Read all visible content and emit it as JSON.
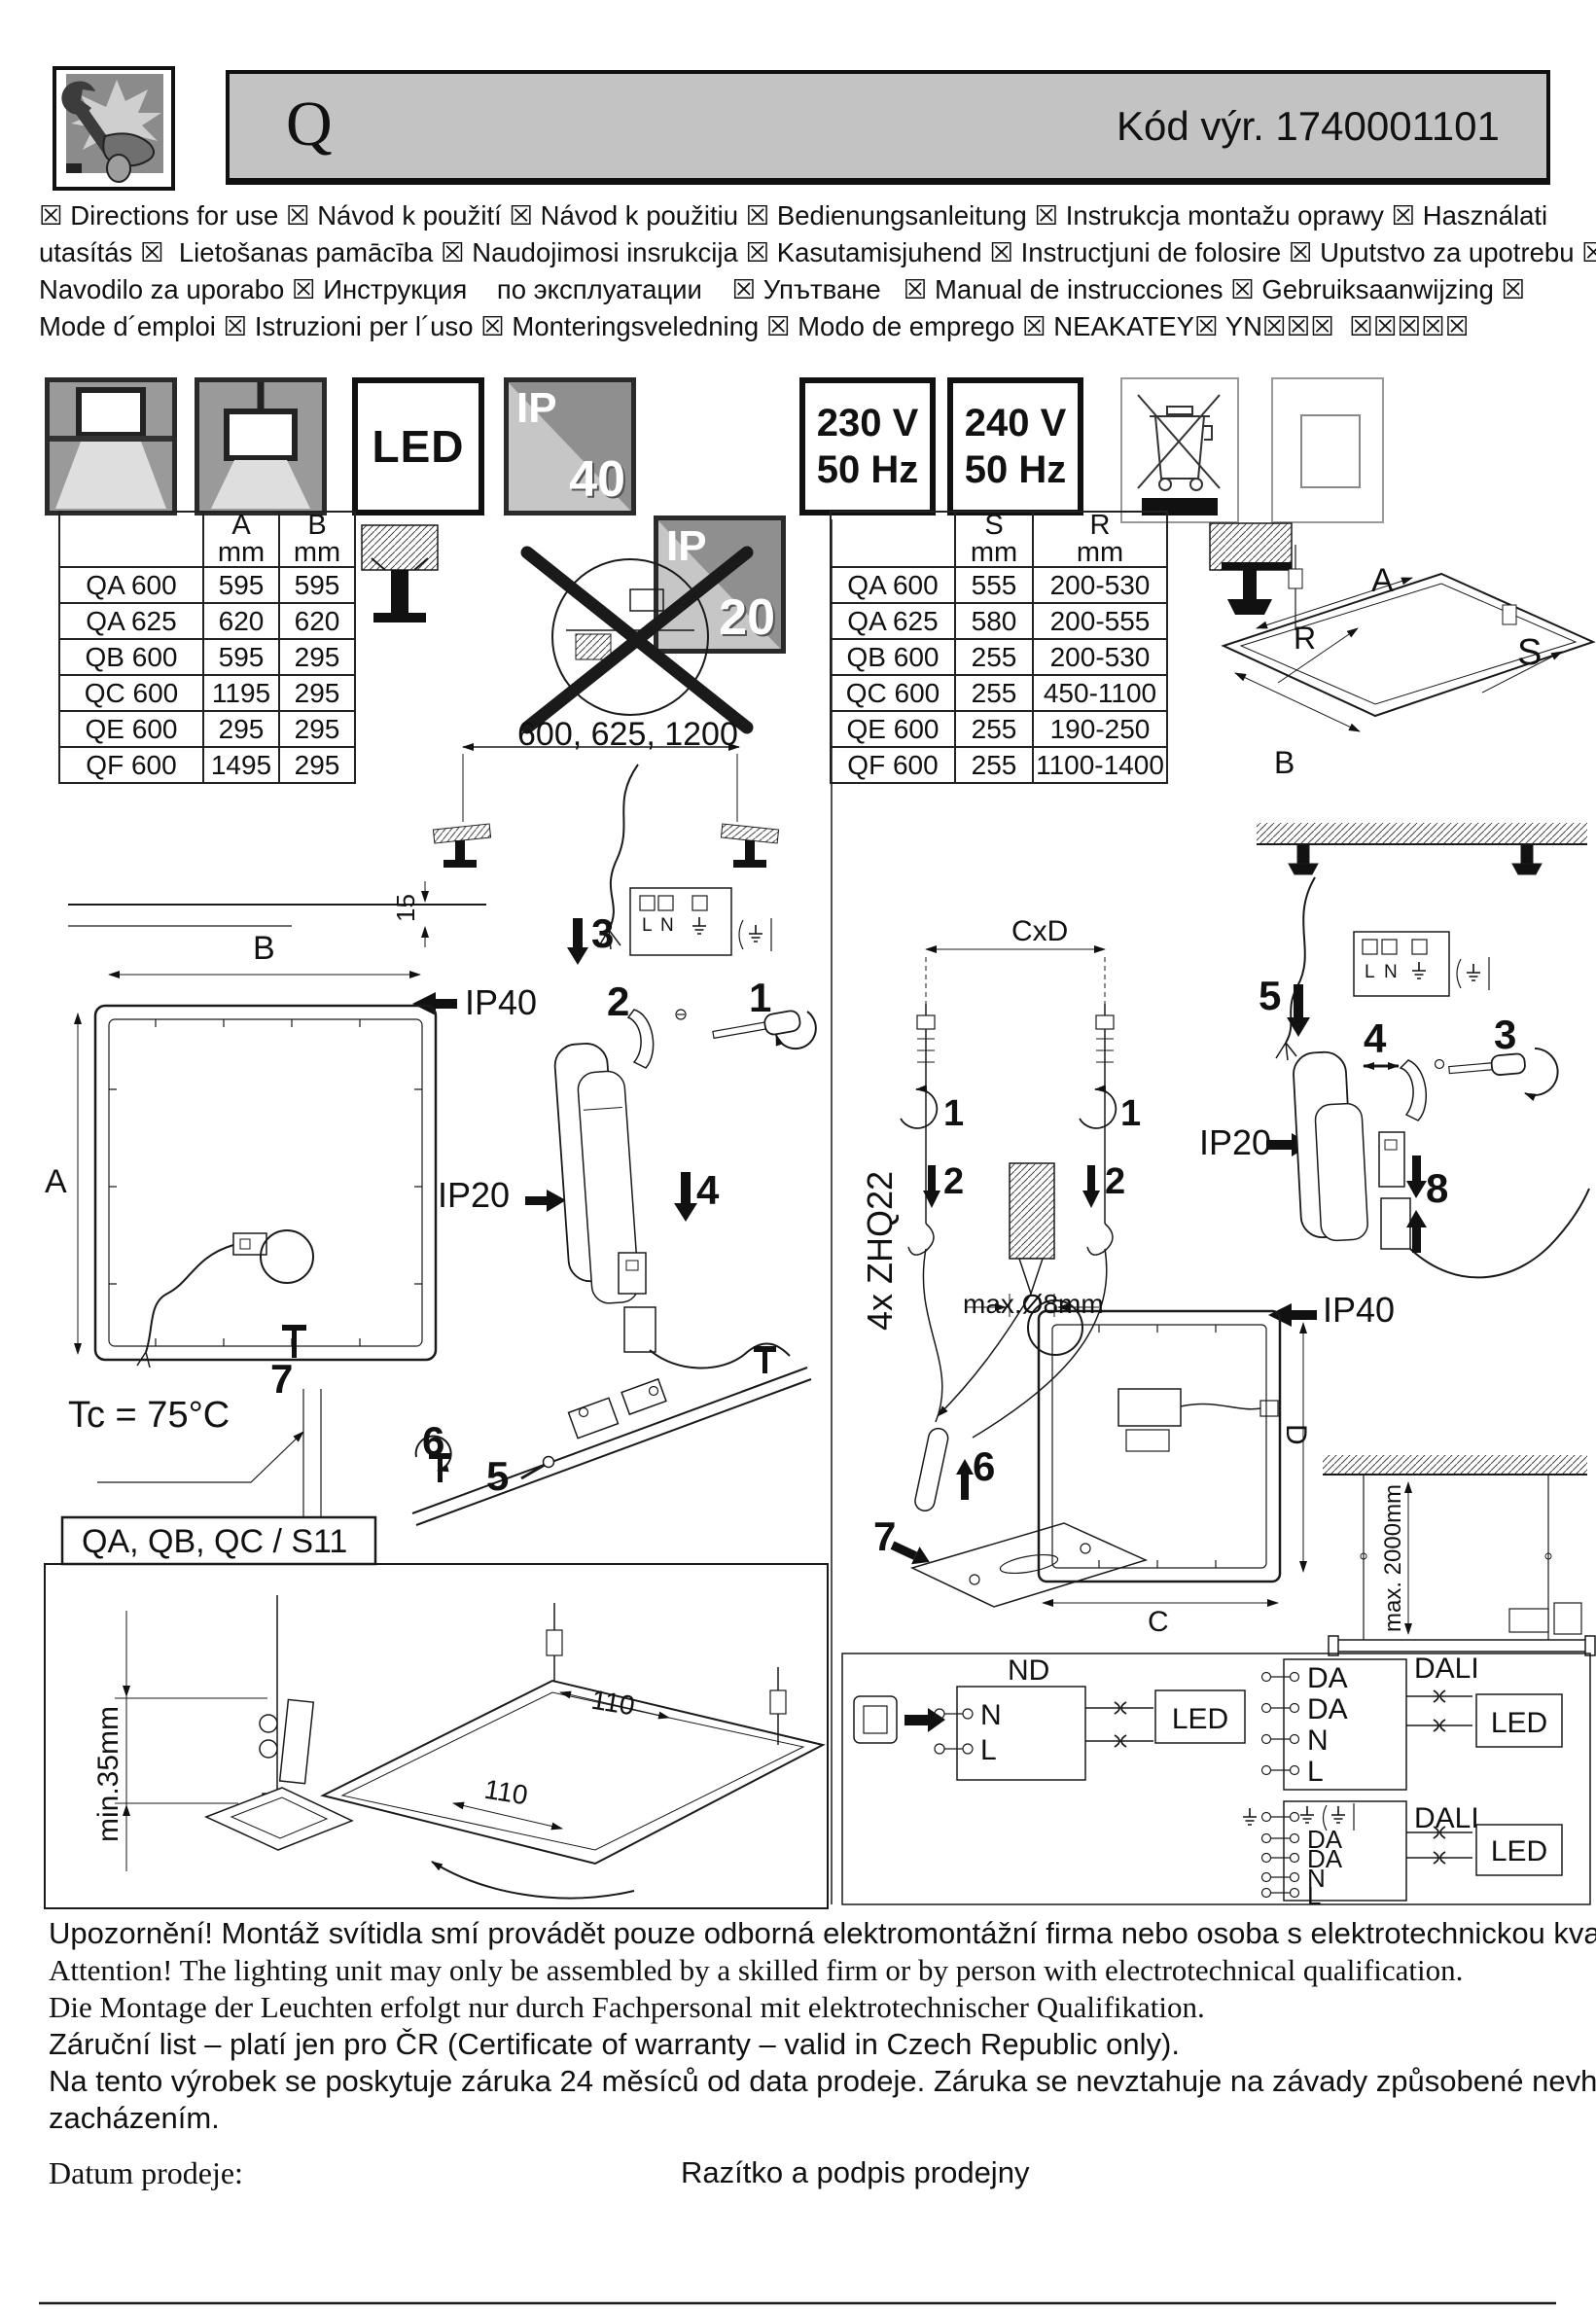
{
  "header": {
    "product_letter": "Q",
    "code": "Kód výr.  1740001101"
  },
  "languages": {
    "lines": [
      "☒ Directions for use ☒ Návod k použití ☒ Návod k použitiu ☒ Bedienungsanleitung ☒ Instrukcja montažu oprawy ☒ Használati",
      "utasítás ☒  Lietošanas pamācība ☒ Naudojimosi insrukcija ☒ Kasutamisjuhend ☒ Instructjuni de folosire ☒ Uputstvo za upotrebu ☒",
      "Navodilo za uporabo ☒ Инструкция    по эксплуатации    ☒ Упътване   ☒ Manual de instrucciones ☒ Gebruiksaanwijzing ☒",
      "Mode d´emploi ☒ Istruzioni per l´uso ☒ Monteringsveledning ☒ Modo de emprego ☒ NEAKATEY☒ YN☒☒☒  ☒☒☒☒☒"
    ]
  },
  "badges": {
    "led": "LED",
    "ip40": {
      "prefix": "IP",
      "value": "40"
    },
    "ip20": {
      "prefix": "IP",
      "value": "20"
    },
    "v230": {
      "voltage": "230 V",
      "freq": "50 Hz"
    },
    "v240": {
      "voltage": "240 V",
      "freq": "50 Hz"
    }
  },
  "table_left": {
    "col_a": "A",
    "col_b": "B",
    "unit": "mm",
    "rows": [
      {
        "name": "QA 600",
        "a": "595",
        "b": "595"
      },
      {
        "name": "QA 625",
        "a": "620",
        "b": "620"
      },
      {
        "name": "QB 600",
        "a": "595",
        "b": "295"
      },
      {
        "name": "QC 600",
        "a": "1195",
        "b": "295"
      },
      {
        "name": "QE 600",
        "a": "295",
        "b": "295"
      },
      {
        "name": "QF 600",
        "a": "1495",
        "b": "295"
      }
    ]
  },
  "table_right": {
    "col_s": "S",
    "col_r": "R",
    "unit": "mm",
    "rows": [
      {
        "name": "QA 600",
        "s": "555",
        "r": "200-530"
      },
      {
        "name": "QA 625",
        "s": "580",
        "r": "200-555"
      },
      {
        "name": "QB 600",
        "s": "255",
        "r": "200-530"
      },
      {
        "name": "QC 600",
        "s": "255",
        "r": "450-1100"
      },
      {
        "name": "QE 600",
        "s": "255",
        "r": "190-250"
      },
      {
        "name": "QF 600",
        "s": "255",
        "r": "1100-1400"
      }
    ]
  },
  "diagram": {
    "span_dim": "600, 625, 1200",
    "dim_15": "15",
    "dim_B": "B",
    "dim_A": "A",
    "ip40": "IP40",
    "ip20": "IP20",
    "steps": {
      "s1": "1",
      "s2": "2",
      "s3": "3",
      "s4": "4",
      "s5": "5",
      "s6": "6",
      "s7": "7",
      "s8": "8"
    },
    "tc": "Tc = 75°C",
    "section": "QA, QB, QC / S11",
    "min35": "min.35mm",
    "dim_110": "110",
    "cxd": "CxD",
    "anchors": "4x ZHQ22",
    "max_drill": "max.Ø8mm",
    "dim_D": "D",
    "dim_C": "C",
    "max_drop": "max. 2000mm",
    "dim_A2": "A",
    "dim_R": "R",
    "dim_S": "S",
    "dim_B2": "B",
    "term_L": "L",
    "term_N": "N"
  },
  "wiring": {
    "nd": "ND",
    "dali": "DALI",
    "led": "LED",
    "nd_terminals": {
      "n": "N",
      "l": "L"
    },
    "dali_terminals": {
      "da1": "DA",
      "da2": "DA",
      "n": "N",
      "l": "L"
    }
  },
  "footer": {
    "lines": [
      "Upozornění! Montáž svítidla smí provádět pouze odborná elektromontážní firma nebo osoba s elektrotechnickou kvalifikací.",
      "Attention! The lighting unit may only be assembled by a skilled firm or by person with electrotechnical qualification.",
      "Die Montage der Leuchten erfolgt nur durch Fachpersonal mit elektrotechnischer Qualifikation.",
      "Záruční list – platí jen pro ČR (Certificate of warranty – valid in Czech Republic only).",
      "Na tento výrobek se poskytuje záruka 24 měsíců od data prodeje. Záruka se nevztahuje na závady způsobené nevhodným",
      "zacházením."
    ],
    "date_label": "Datum prodeje:",
    "stamp_label": "Razítko a podpis prodejny"
  }
}
